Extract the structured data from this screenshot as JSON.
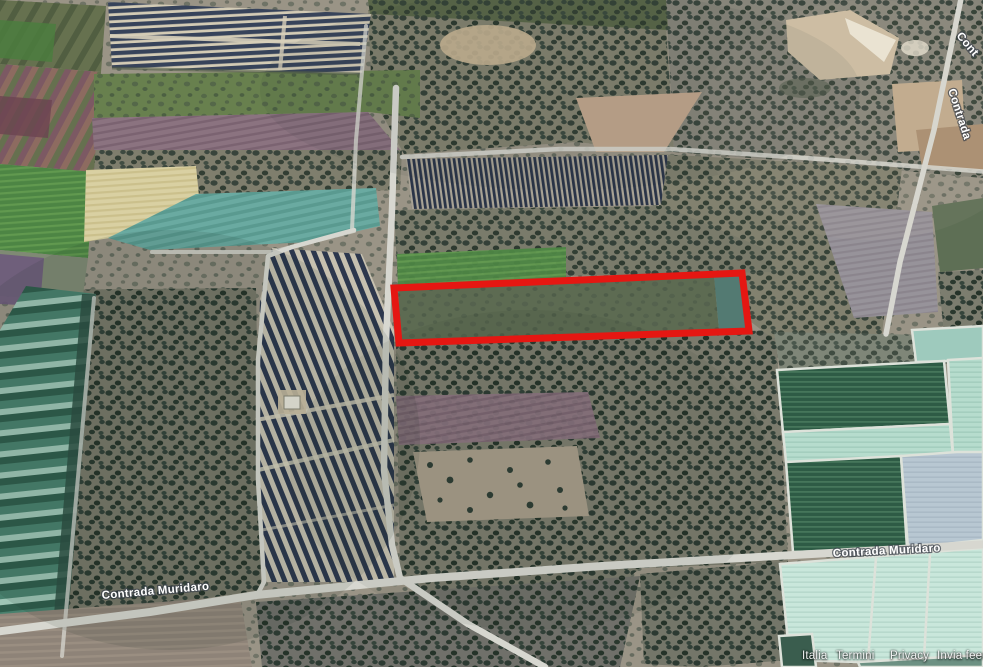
{
  "map": {
    "road_labels": [
      {
        "text": "Contrada Muridaro"
      },
      {
        "text": "Contrada Muridaro"
      },
      {
        "text": "Cont"
      },
      {
        "text": "Contrada"
      }
    ],
    "highlight": {
      "shape": "rectangle",
      "stroke_color": "#e51712"
    },
    "attribution": {
      "items": [
        "Italia",
        "Termini",
        "Privacy",
        "Invia feedb"
      ]
    }
  }
}
